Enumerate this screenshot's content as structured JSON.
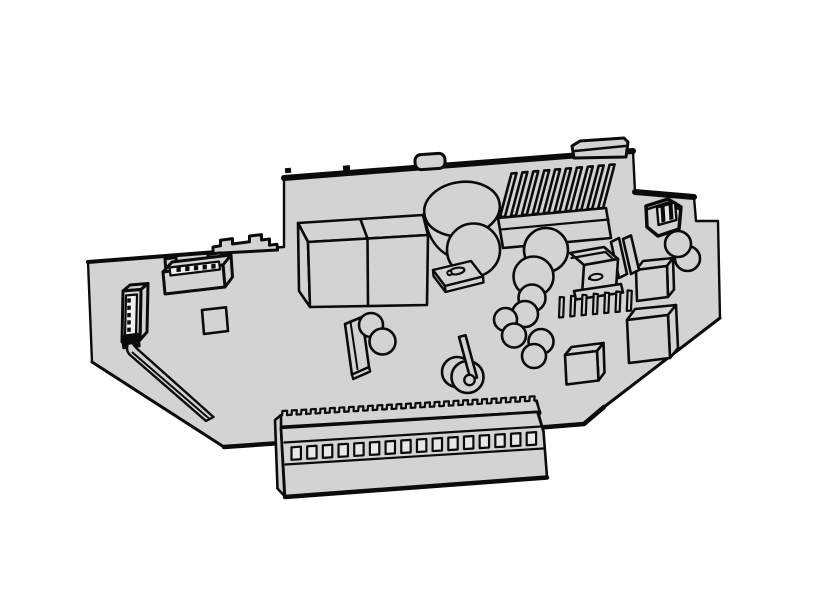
{
  "figure": {
    "kind": "technical-illustration",
    "subject": "printed-circuit-board-assembly-isometric-line-art"
  },
  "colors": {
    "background": "#ffffff",
    "board_fill": "#d3d3d3",
    "line": "#0b0b0b",
    "window_fill": "#e7e7e7",
    "cavity_fill": "#efefef"
  },
  "components": {
    "heatsink": {
      "name": "finned-heatsink",
      "fin_count": 10
    },
    "comb_heatsink": {
      "name": "comb-heatsink",
      "fin_count": 7
    },
    "pin_header": {
      "name": "pin-header",
      "pin_count": 5
    },
    "vertical_connector": {
      "name": "vertical-connector",
      "pin_count": 5
    },
    "terminal_block": {
      "name": "terminal-block",
      "window_count": 16,
      "serration_teeth": 27
    }
  },
  "parts": [
    {
      "name": "pcb-board"
    },
    {
      "name": "transformer-block"
    },
    {
      "name": "large-electrolytic-capacitor"
    },
    {
      "name": "capacitor-mounting-bracket"
    },
    {
      "name": "finned-heatsink"
    },
    {
      "name": "two-pin-connector"
    },
    {
      "name": "tilted-capacitor-right"
    },
    {
      "name": "ic-cube-right"
    },
    {
      "name": "ssr-module"
    },
    {
      "name": "capacitor-cluster"
    },
    {
      "name": "ic-cube-large"
    },
    {
      "name": "ic-cube-small"
    },
    {
      "name": "film-capacitor"
    },
    {
      "name": "tilted-capacitor-center"
    },
    {
      "name": "wire-loop-jumper"
    },
    {
      "name": "pin-header"
    },
    {
      "name": "vertical-connector"
    },
    {
      "name": "ribbon-strip"
    },
    {
      "name": "smd-pad"
    },
    {
      "name": "terminal-block"
    },
    {
      "name": "mounting-tab-rect"
    },
    {
      "name": "mounting-tab-round"
    },
    {
      "name": "din-clip"
    }
  ]
}
